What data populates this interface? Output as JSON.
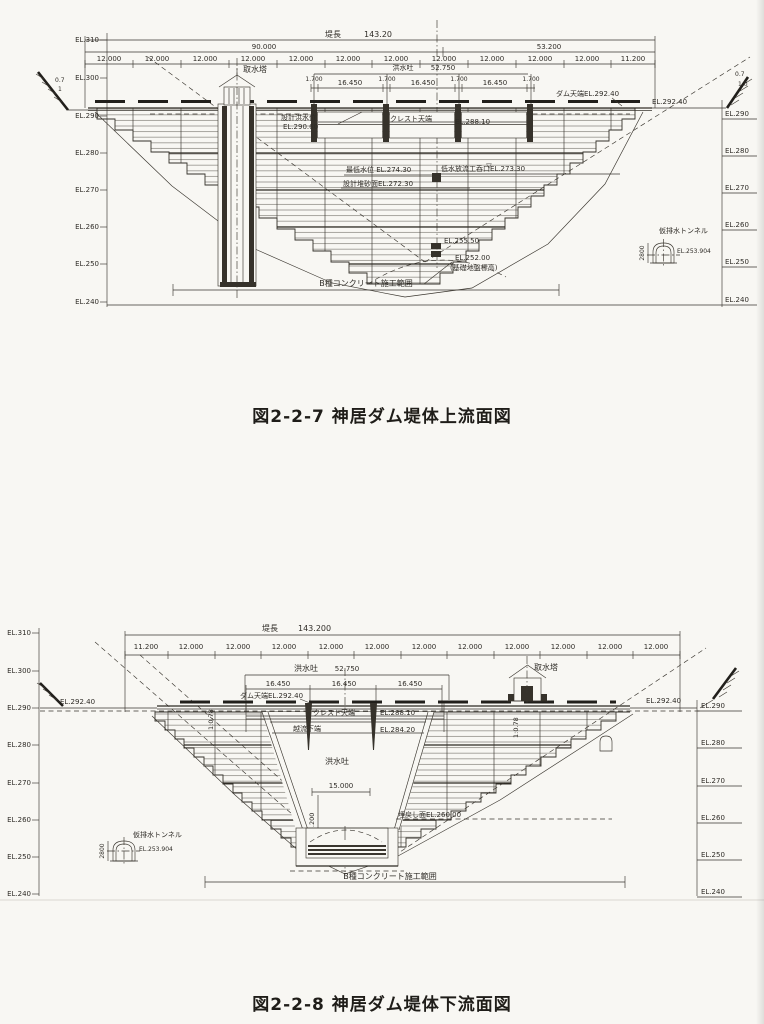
{
  "page": {
    "background": "#f8f7f3",
    "ink": "#2f2c27"
  },
  "fig1": {
    "caption": "図2-2-7  神居ダム堤体上流面図",
    "axis_left": [
      "EL.310",
      "EL.300",
      "EL.290",
      "EL.280",
      "EL.270",
      "EL.260",
      "EL.250",
      "EL.240"
    ],
    "axis_right": [
      "EL.290",
      "EL.280",
      "EL.270",
      "EL.260",
      "EL.250",
      "EL.240"
    ],
    "dam_length_label": "堤長",
    "dam_length_value": "143.20",
    "span_left": "90.000",
    "span_right": "53.200",
    "seg": "12.000",
    "seg_end": "11.200",
    "spillway_label": "洪水吐",
    "spillway_value": "52.750",
    "pier_w": "1.700",
    "bay_w": "16.450",
    "intake_tower": "取水塔",
    "dam_crest_label": "ダム天端EL.292.40",
    "crest_el": "EL.292.40",
    "design_flood_line1": "設計洪水位",
    "design_flood_line2": "EL.290.60",
    "crest_top": "クレスト天端",
    "crest_top_el": "EL.288.10",
    "min_water": "最低水位 EL.274.30",
    "sediment": "設計堆砂面EL.272.30",
    "outlet": "低水放流工呑口EL.273.30",
    "el_255": "EL.255.50",
    "el_252": "EL.252.00",
    "el_252_note": "(基礎地盤標高)",
    "b_concrete": "B種コンクリート施工範囲",
    "tunnel": "仮排水トンネル",
    "tunnel_el": "EL.253.904",
    "tunnel_h": "2800",
    "slope_left_num": "0.7",
    "slope_left_den": "1",
    "slope_right_num": "0.7",
    "slope_right_den": "1.0",
    "water_mark": "▽"
  },
  "fig2": {
    "caption": "図2-2-8  神居ダム堤体下流面図",
    "axis_left": [
      "EL.310",
      "EL.300",
      "EL.290",
      "EL.280",
      "EL.270",
      "EL.260",
      "EL.250",
      "EL.240"
    ],
    "axis_right": [
      "EL.290",
      "EL.280",
      "EL.270",
      "EL.260",
      "EL.250",
      "EL.240"
    ],
    "dam_length_label": "堤長",
    "dam_length_value": "143.200",
    "seg": "12.000",
    "seg_first": "11.200",
    "spillway_label": "洪水吐",
    "spillway_value": "52.750",
    "bay_w": "16.450",
    "dam_crest_label": "ダム天端EL.292.40",
    "crest_el_left": "EL.292.40",
    "crest_el_right": "EL.292.40",
    "crest_top": "クレスト天端",
    "crest_top_el": "EL.288.10",
    "overflow_bottom": "越流下端",
    "overflow_bottom_el": "EL.284.20",
    "chute_label": "洪水吐",
    "chute_width": "15.000",
    "basin_depth": "14.200",
    "slope_ratio": "1:0.78",
    "backfill": "埋戻し面EL.260.00",
    "intake_tower": "取水塔",
    "tunnel": "仮排水トンネル",
    "tunnel_el": "EL.253.904",
    "tunnel_h": "2800",
    "b_concrete": "B種コンクリート施工範囲"
  }
}
